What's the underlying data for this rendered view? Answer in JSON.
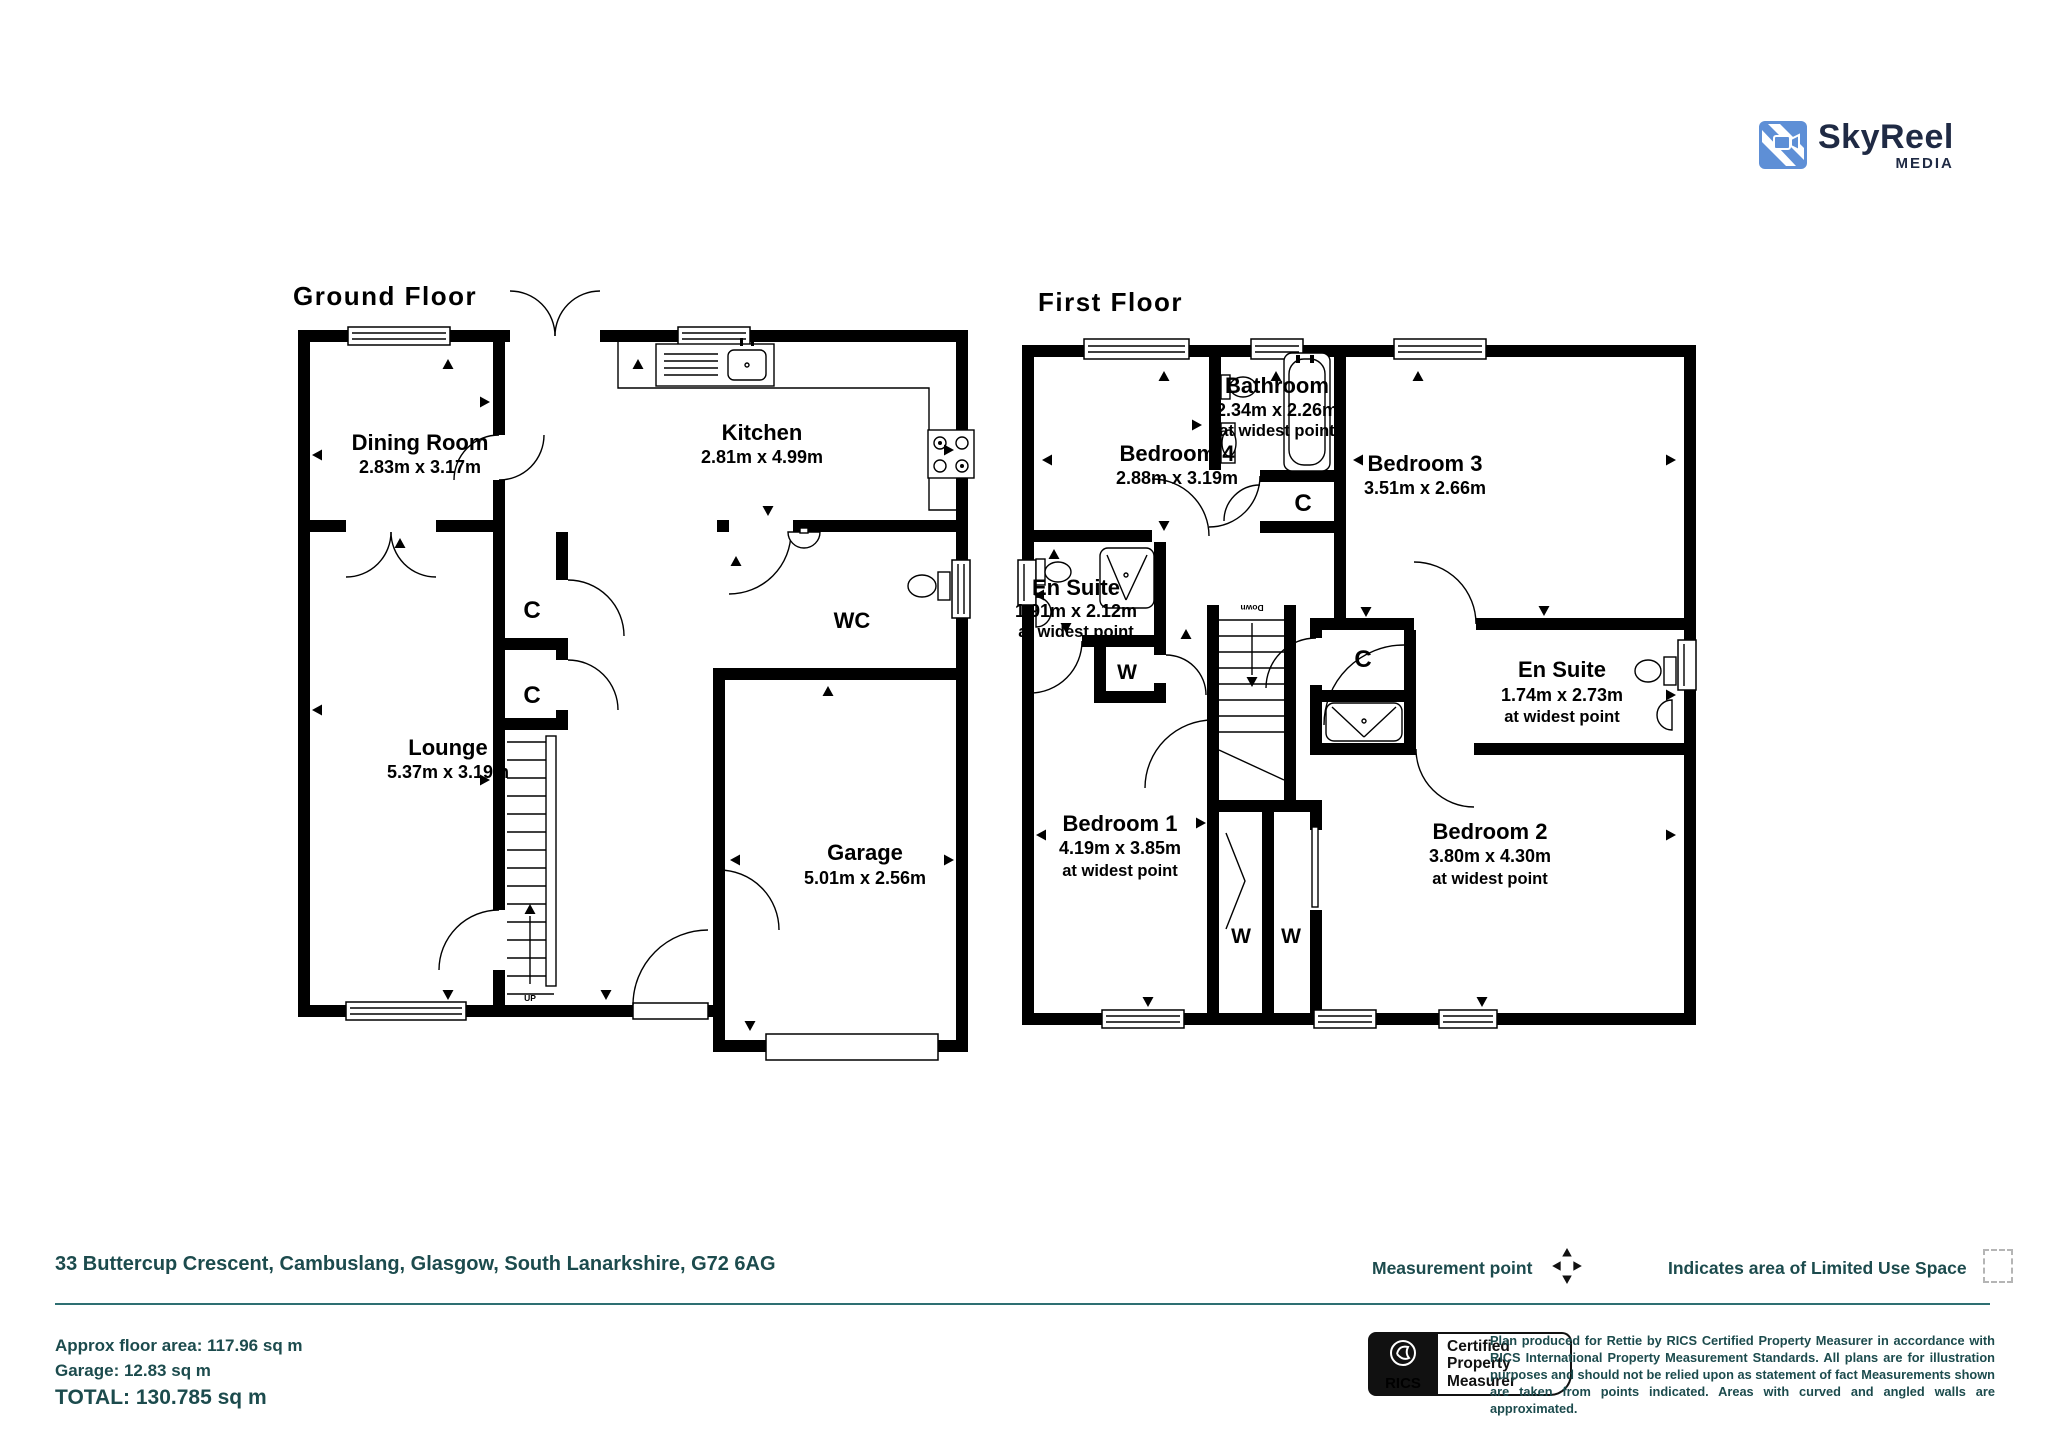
{
  "logo": {
    "name": "SkyReel",
    "media": "MEDIA"
  },
  "floors": {
    "ground": {
      "title": "Ground Floor",
      "rooms": {
        "dining": {
          "name": "Dining Room",
          "dims": "2.83m x 3.17m"
        },
        "kitchen": {
          "name": "Kitchen",
          "dims": "2.81m x 4.99m"
        },
        "lounge": {
          "name": "Lounge",
          "dims": "5.37m x 3.19m"
        },
        "wc": {
          "name": "WC"
        },
        "garage": {
          "name": "Garage",
          "dims": "5.01m x 2.56m"
        }
      },
      "closet1": "C",
      "closet2": "C",
      "stairs": "UP"
    },
    "first": {
      "title": "First Floor",
      "rooms": {
        "bedroom4": {
          "name": "Bedroom 4",
          "dims": "2.88m x 3.19m"
        },
        "bathroom": {
          "name": "Bathroom",
          "dims": "2.34m x 2.26m",
          "note": "at widest point"
        },
        "bedroom3": {
          "name": "Bedroom 3",
          "dims": "3.51m x 2.66m"
        },
        "ensuite1": {
          "name": "En Suite",
          "dims": "1.91m x 2.12m",
          "note": "at widest point"
        },
        "ensuite2": {
          "name": "En Suite",
          "dims": "1.74m x 2.73m",
          "note": "at widest point"
        },
        "bedroom1": {
          "name": "Bedroom 1",
          "dims": "4.19m x 3.85m",
          "note": "at widest point"
        },
        "bedroom2": {
          "name": "Bedroom 2",
          "dims": "3.80m x 4.30m",
          "note": "at widest point"
        }
      },
      "closet1": "C",
      "closet2": "C",
      "wardrobe1": "W",
      "wardrobe2": "W",
      "wardrobe3": "W",
      "stairs": "Down"
    }
  },
  "footer": {
    "address": "33 Buttercup Crescent, Cambuslang, Glasgow, South Lanarkshire, G72 6AG",
    "legend": {
      "measurement": "Measurement point",
      "limited": "Indicates area of Limited Use Space"
    },
    "areas": {
      "floor": "Approx floor area: 117.96 sq m",
      "garage": "Garage: 12.83 sq m",
      "total": "TOTAL: 130.785 sq m"
    },
    "rics": {
      "label": "RICS",
      "badge_line1": "Certified",
      "badge_line2": "Property",
      "badge_line3": "Measurer"
    },
    "disclaimer": "Plan produced for Rettie by RICS Certified Property Measurer in accordance with RICS International Property Measurement Standards. All plans are for illustration purposes and should not be relied upon as statement of fact Measurements shown are taken from points indicated. Areas with curved and angled walls are approximated."
  },
  "colors": {
    "teal_text": "#1C4B4D",
    "rule_teal": "#2E6F72",
    "logo_blue": "#5E8FD6",
    "logo_navy": "#1F2A44",
    "plan_black": "#000000"
  }
}
